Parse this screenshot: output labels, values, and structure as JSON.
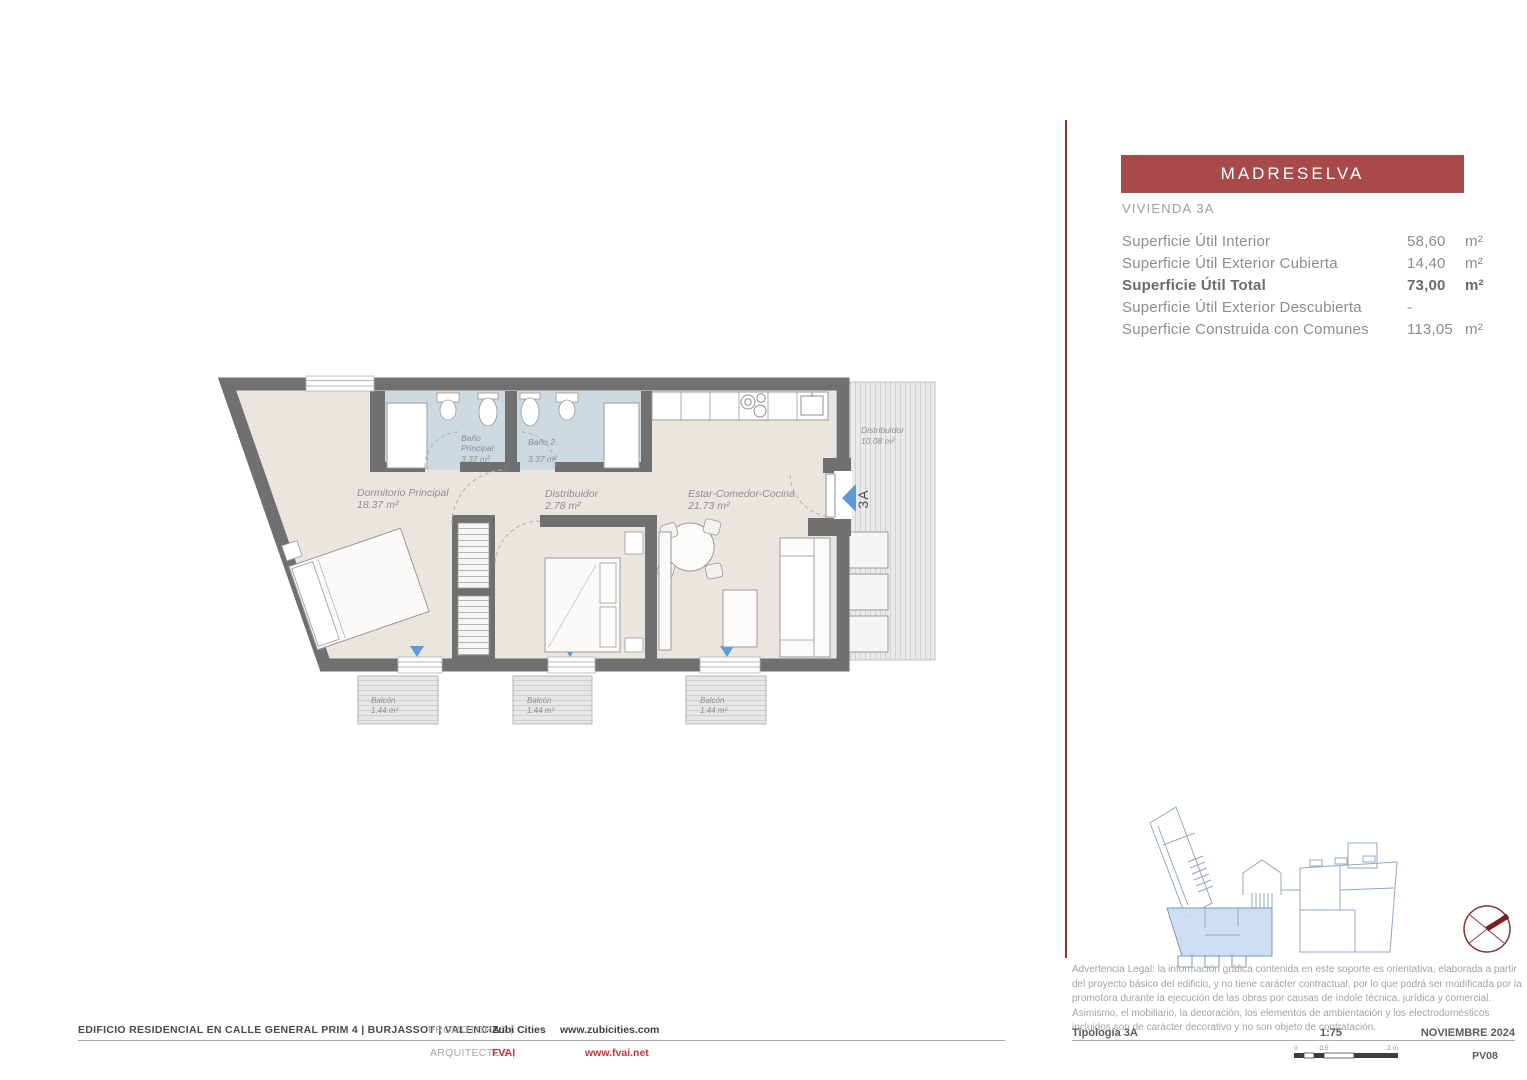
{
  "panel": {
    "title": "MADRESELVA",
    "subtitle": "VIVIENDA 3A",
    "areas": [
      {
        "label": "Superficie Útil Interior",
        "value": "58,60",
        "unit": "m²"
      },
      {
        "label": "Superficie Útil Exterior Cubierta",
        "value": "14,40",
        "unit": "m²"
      },
      {
        "label": "Superficie Útil Total",
        "value": "73,00",
        "unit": "m²"
      },
      {
        "label": "Superficie Útil Exterior Descubierta",
        "value": "-",
        "unit": ""
      },
      {
        "label": "Superficie Construida con Comunes",
        "value": "113,05",
        "unit": "m²"
      }
    ],
    "legal": "Advertencia Legal: la información gráfica contenida en este soporte es orientativa, elaborada a partir del proyecto básico del edificio, y no tiene carácter contractual, por lo que podrá ser modificada por la promotora durante la ejecución de las obras por causas de índole técnica, jurídica y comercial. Asimismo, el mobiliario, la decoración, los elementos de ambientación y los electrodomésticos incluidos son de carácter decorativo y no son objeto de contratación."
  },
  "plan": {
    "rooms": {
      "dormitorio": {
        "name": "Dormitorio Principal",
        "area": "18.37 m²"
      },
      "bano_principal": {
        "line1": "Baño",
        "line2": "Principal",
        "area": "3.37 m²"
      },
      "bano2": {
        "name": "Baño 2",
        "area": "3.37 m²"
      },
      "distribuidor": {
        "name": "Distribuidor",
        "area": "2.78 m²"
      },
      "estar": {
        "name": "Estar-Comedor-Cocina",
        "area": "21.73 m²"
      },
      "terraza": {
        "name": "Distribuidor",
        "area": "10.08 m²"
      },
      "balcon1": {
        "name": "Balcón",
        "area": "1.44 m²"
      },
      "balcon2": {
        "name": "Balcón",
        "area": "1.44 m²"
      },
      "balcon3": {
        "name": "Balcón",
        "area": "1.44 m²"
      }
    },
    "unit_marker": "3A"
  },
  "footer": {
    "project": "EDIFICIO RESIDENCIAL EN CALLE GENERAL PRIM 4 | BURJASSOT | VALENCIA",
    "promotores_label": "PROMOTORES |",
    "promotores_name": "Zubi Cities",
    "promotores_web": "www.zubicities.com",
    "arquitectos_label": "ARQUITECTOS |",
    "arquitectos_name": "FVAI",
    "arquitectos_web": "www.fvai.net",
    "tipologia": "Tipología 3A",
    "escala": "1:75",
    "fecha": "NOVIEMBRE 2024",
    "plano": "PV08",
    "scale_zero": "0",
    "scale_half": "0.5",
    "scale_two": "2 m"
  },
  "colors": {
    "accent_red": "#a84a4a",
    "divider_red": "#8f3336",
    "wall_gray": "#707070",
    "floor_beige": "#eae6df",
    "bath_blue": "#cdd9e0",
    "marker_blue": "#5b9bd5",
    "siteplan_blue": "#c9dcf2",
    "link_red": "#c0393b"
  }
}
